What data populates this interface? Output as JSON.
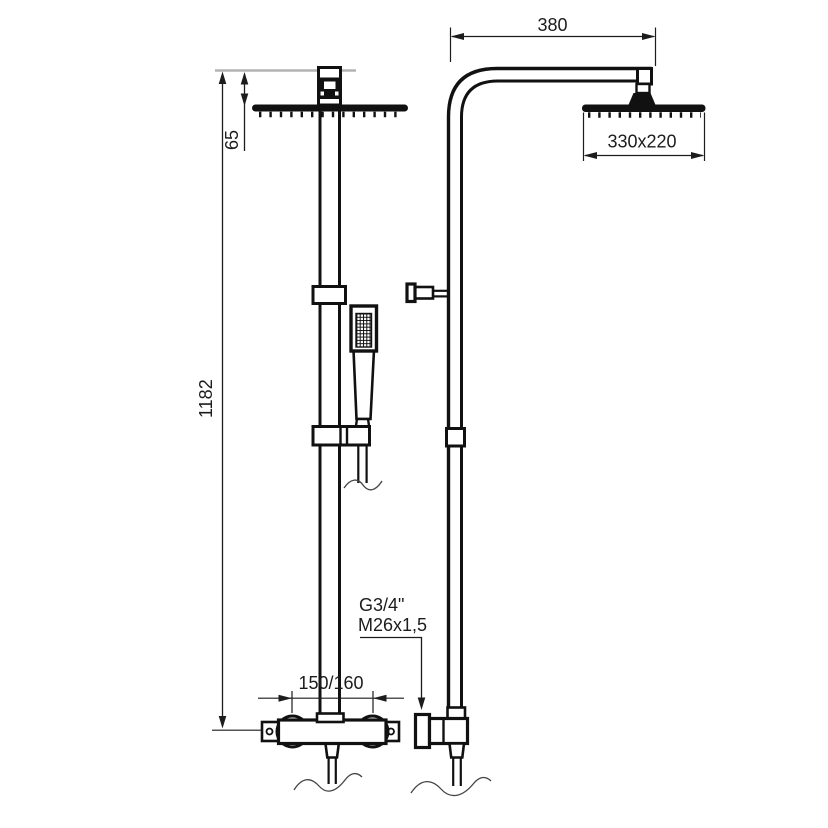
{
  "diagram": {
    "dimensions": {
      "arm_reach": "380",
      "overhead_shower_size": "330x220",
      "ceiling_drop": "65",
      "column_height": "1182",
      "supply_spacing": "150/160"
    },
    "connection_labels": {
      "thread": "G3/4\"",
      "nut": "M26x1,5"
    },
    "colors": {
      "line": "#111111",
      "dimension_line": "#1c1c1c",
      "reference_line": "#b3b3b3",
      "background": "#ffffff"
    }
  }
}
